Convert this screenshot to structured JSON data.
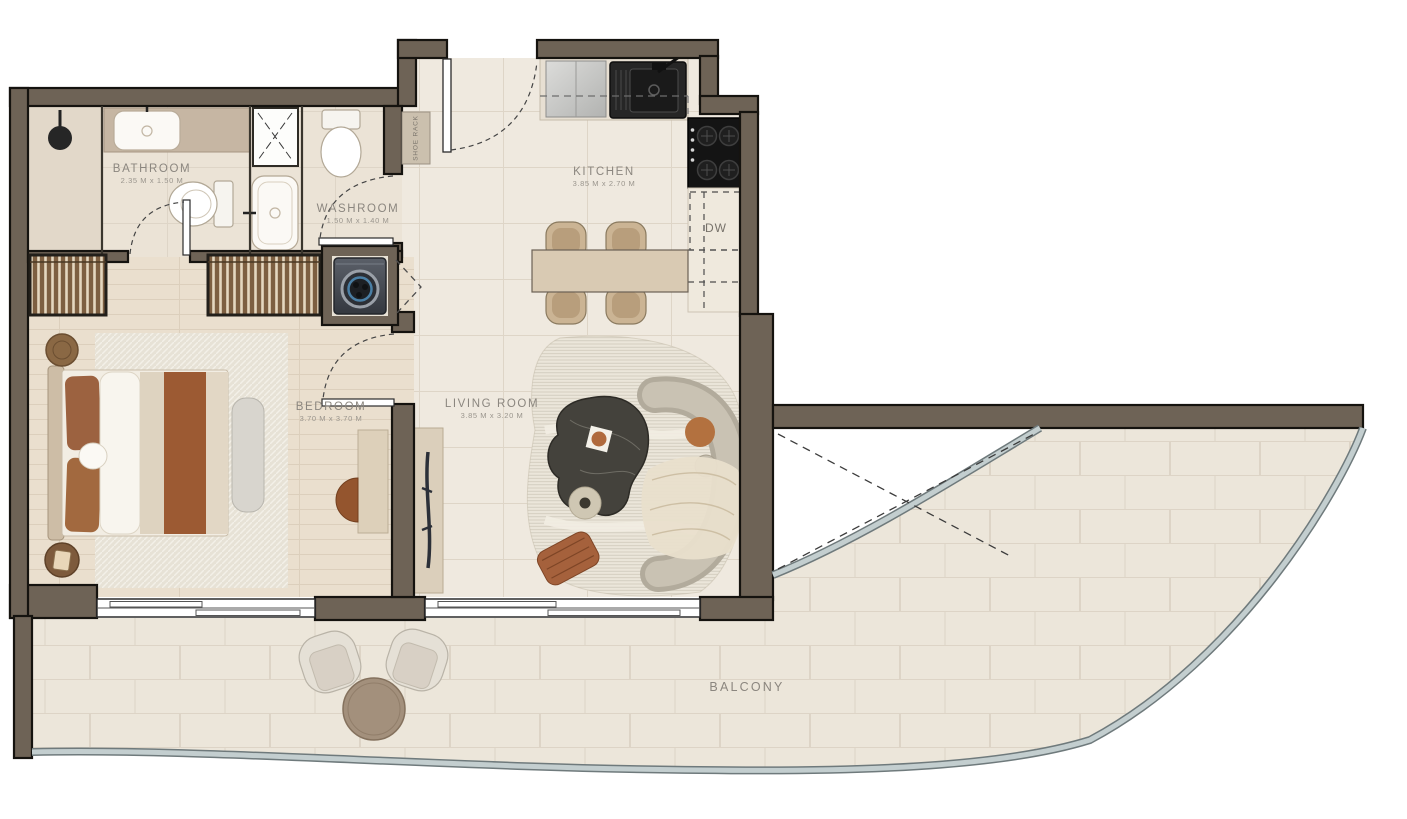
{
  "plan_title": "One-bedroom apartment floor plan with balcony",
  "rooms": {
    "bathroom": {
      "name": "BATHROOM",
      "dims": "2.35 M x 1.50 M"
    },
    "washroom": {
      "name": "WASHROOM",
      "dims": "1.50 M x 1.40 M"
    },
    "kitchen": {
      "name": "KITCHEN",
      "dims": "3.85 M x 2.70 M"
    },
    "bedroom": {
      "name": "BEDROOM",
      "dims": "3.70 M x 3.70 M"
    },
    "living": {
      "name": "LIVING ROOM",
      "dims": "3.85 M x 3.20 M"
    },
    "balcony": {
      "name": "BALCONY",
      "dims": ""
    }
  },
  "annotations": {
    "dishwasher": "DW",
    "shoe_rack": "SHOE RACK"
  },
  "palette": {
    "wall": "#6e6356",
    "wall_outline": "#15130f",
    "floor_main": "#efe9df",
    "floor_bedroom": "#eadfce",
    "floor_bath": "#ebe3d6",
    "floor_balcony": "#ece6da",
    "glass_balustrade": "#c3cecf",
    "accent_rust": "#9c5a33",
    "appliance_dark": "#141414",
    "label_text": "#8b867f"
  },
  "fixtures": [
    "shower-head",
    "bathroom-sink",
    "bathroom-toilet",
    "shower-stall",
    "washroom-sink",
    "washroom-toilet",
    "washing-machine",
    "fridge",
    "kitchen-sink",
    "stove",
    "dishwasher",
    "dining-table",
    "dining-chairs",
    "wardrobes",
    "bed",
    "bench",
    "side-tables",
    "desk",
    "desk-chair",
    "tv-console",
    "sofa",
    "coffee-table",
    "pouf",
    "floor-cushion",
    "rug",
    "balcony-armchairs",
    "balcony-table"
  ]
}
